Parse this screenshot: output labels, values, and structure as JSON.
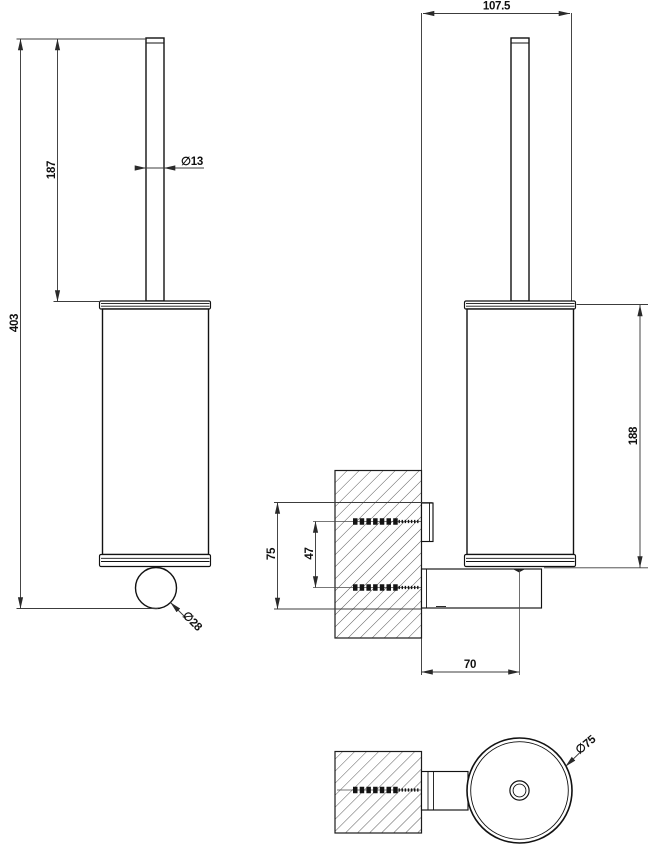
{
  "drawing": {
    "kind": "technical dimensional drawing",
    "subject": "wall-mounted toilet brush holder",
    "units": "mm"
  },
  "colors": {
    "background": "#ffffff",
    "object_line": "#121212",
    "dimension_line": "#3c3c3c",
    "text": "#101010"
  },
  "views": {
    "front": {
      "name": "front view",
      "labels": {
        "overall_height": "403",
        "handle_length": "187",
        "handle_diameter": "∅13",
        "knob_diameter": "∅28"
      }
    },
    "side": {
      "name": "side view with wall section",
      "labels": {
        "overall_depth": "107.5",
        "holder_height": "188",
        "mounting_height": "75",
        "screw_spacing": "47",
        "wall_to_axis": "70"
      }
    },
    "bottom": {
      "name": "bottom view",
      "labels": {
        "holder_diameter": "∅75"
      }
    }
  }
}
